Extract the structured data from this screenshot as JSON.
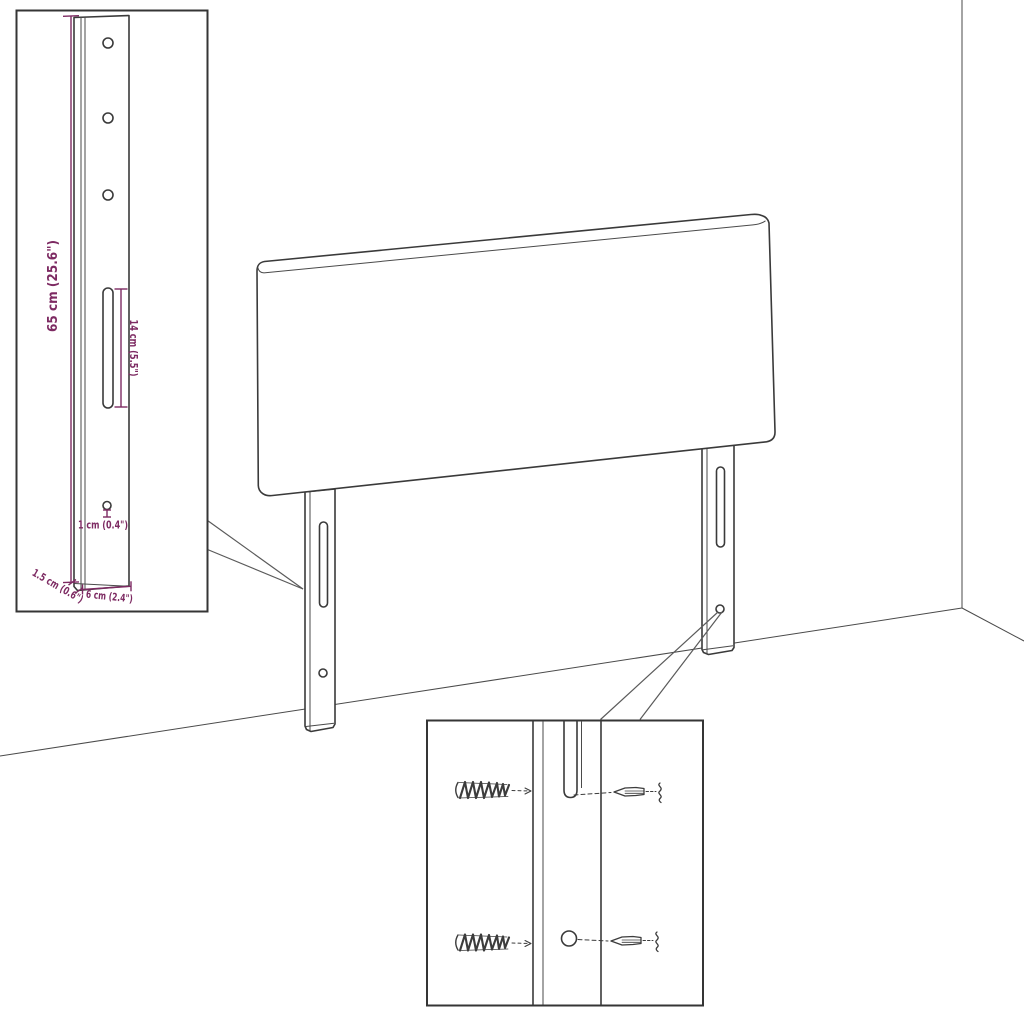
{
  "diagram": {
    "type": "furniture-headboard-dimension-diagram",
    "colors": {
      "background": "#ffffff",
      "line": "#3a3a3a",
      "dimension": "#7d2a62"
    },
    "dimensions": {
      "height": "65 cm (25.6\")",
      "slot_length": "14 cm (5.5\")",
      "hole_diameter": "1 cm (0.4\")",
      "thickness": "1.5 cm (0.6\")",
      "width": "6 cm (2.4\")"
    }
  }
}
